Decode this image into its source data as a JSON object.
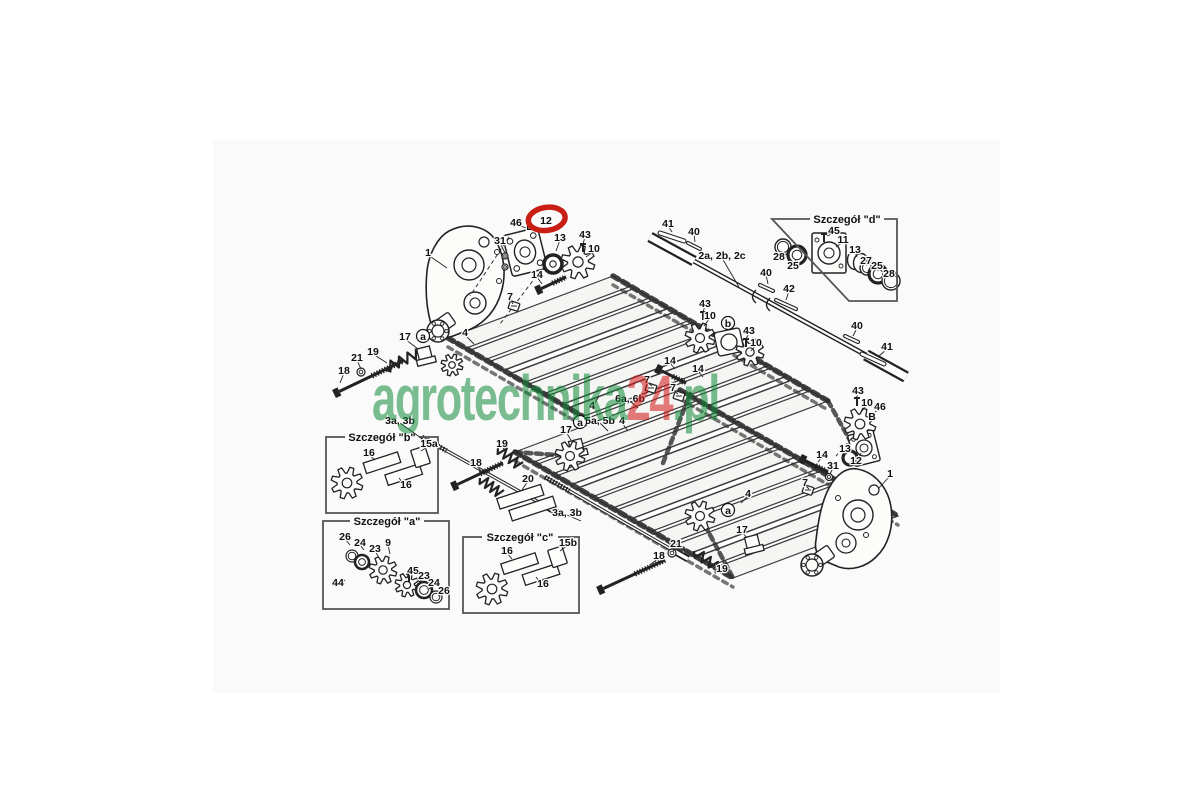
{
  "page": {
    "background": "#ffffff",
    "image_area_background": "#fafafa"
  },
  "watermark": {
    "part1": "agrotechnika",
    "part2": "24",
    "part3": ".pl",
    "color_main": "#0f8a38",
    "color_accent": "#d21414",
    "opacity": 0.55
  },
  "diagram": {
    "highlight_color": "#c81e14",
    "line_color": "#222222",
    "detail_boxes": [
      {
        "id": "d",
        "label": "Szczegół \"d\""
      },
      {
        "id": "b",
        "label": "Szczegół \"b\""
      },
      {
        "id": "a",
        "label": "Szczegół \"a\""
      },
      {
        "id": "c",
        "label": "Szczegół \"c\""
      }
    ],
    "callouts": [
      {
        "label": "1",
        "x": 428,
        "y": 253,
        "lx": 447,
        "ly": 268
      },
      {
        "label": "46",
        "x": 516,
        "y": 223,
        "lx": 527,
        "ly": 228
      },
      {
        "label": "B",
        "x": 530,
        "y": 227
      },
      {
        "label": "12",
        "x": 546,
        "y": 221,
        "highlight": true
      },
      {
        "label": "31",
        "x": 500,
        "y": 241,
        "lx": 505,
        "ly": 253
      },
      {
        "label": "13",
        "x": 560,
        "y": 238,
        "lx": 556,
        "ly": 251
      },
      {
        "label": "43",
        "x": 585,
        "y": 235,
        "lx": 583,
        "ly": 244
      },
      {
        "label": "10",
        "x": 594,
        "y": 249,
        "lx": 586,
        "ly": 257
      },
      {
        "label": "14",
        "x": 537,
        "y": 275,
        "lx": 542,
        "ly": 284
      },
      {
        "label": "7",
        "x": 510,
        "y": 297,
        "lx": 513,
        "ly": 304
      },
      {
        "label": "4",
        "x": 465,
        "y": 333,
        "lx": 474,
        "ly": 344
      },
      {
        "label": "17",
        "x": 405,
        "y": 337,
        "lx": 418,
        "ly": 349
      },
      {
        "label": "a",
        "x": 423,
        "y": 337,
        "circled": true
      },
      {
        "label": "19",
        "x": 373,
        "y": 352,
        "lx": 387,
        "ly": 363
      },
      {
        "label": "21",
        "x": 357,
        "y": 358,
        "lx": 361,
        "ly": 369
      },
      {
        "label": "18",
        "x": 344,
        "y": 371,
        "lx": 340,
        "ly": 383
      },
      {
        "label": "3a, 3b",
        "x": 400,
        "y": 421,
        "lx": 428,
        "ly": 443
      },
      {
        "label": "41",
        "x": 668,
        "y": 224,
        "lx": 672,
        "ly": 232
      },
      {
        "label": "40",
        "x": 694,
        "y": 232,
        "lx": 695,
        "ly": 242
      },
      {
        "label": "2a, 2b, 2c",
        "x": 722,
        "y": 256,
        "lx": 739,
        "ly": 287
      },
      {
        "label": "40",
        "x": 766,
        "y": 273,
        "lx": 768,
        "ly": 284
      },
      {
        "label": "42",
        "x": 789,
        "y": 289,
        "lx": 786,
        "ly": 300
      },
      {
        "label": "43",
        "x": 705,
        "y": 304,
        "lx": 703,
        "ly": 312
      },
      {
        "label": "10",
        "x": 710,
        "y": 316,
        "lx": 704,
        "ly": 326
      },
      {
        "label": "b",
        "x": 728,
        "y": 324,
        "circled": true
      },
      {
        "label": "43",
        "x": 749,
        "y": 331,
        "lx": 746,
        "ly": 339
      },
      {
        "label": "10",
        "x": 756,
        "y": 343,
        "lx": 751,
        "ly": 351
      },
      {
        "label": "40",
        "x": 857,
        "y": 326,
        "lx": 853,
        "ly": 336
      },
      {
        "label": "41",
        "x": 887,
        "y": 347,
        "lx": 879,
        "ly": 356
      },
      {
        "label": "14",
        "x": 670,
        "y": 361,
        "lx": 675,
        "ly": 369
      },
      {
        "label": "14",
        "x": 698,
        "y": 369,
        "lx": 703,
        "ly": 377
      },
      {
        "label": "7",
        "x": 647,
        "y": 380,
        "lx": 652,
        "ly": 386
      },
      {
        "label": "7",
        "x": 673,
        "y": 388,
        "lx": 678,
        "ly": 394
      },
      {
        "label": "6a, 6b",
        "x": 630,
        "y": 399,
        "lx": 638,
        "ly": 408
      },
      {
        "label": "4",
        "x": 592,
        "y": 406,
        "lx": 599,
        "ly": 396
      },
      {
        "label": "5a, 5b",
        "x": 600,
        "y": 421,
        "lx": 608,
        "ly": 431
      },
      {
        "label": "4",
        "x": 622,
        "y": 421,
        "lx": 628,
        "ly": 431
      },
      {
        "label": "17",
        "x": 566,
        "y": 430,
        "lx": 571,
        "ly": 440
      },
      {
        "label": "a",
        "x": 580,
        "y": 423,
        "circled": true
      },
      {
        "label": "19",
        "x": 502,
        "y": 444,
        "lx": 505,
        "ly": 451
      },
      {
        "label": "18",
        "x": 476,
        "y": 463,
        "lx": 481,
        "ly": 471
      },
      {
        "label": "20",
        "x": 528,
        "y": 479,
        "lx": 522,
        "ly": 490
      },
      {
        "label": "3a, 3b",
        "x": 567,
        "y": 513,
        "lx": 581,
        "ly": 521
      },
      {
        "label": "21",
        "x": 676,
        "y": 544,
        "lx": 673,
        "ly": 551
      },
      {
        "label": "18",
        "x": 659,
        "y": 556,
        "lx": 651,
        "ly": 564
      },
      {
        "label": "4",
        "x": 748,
        "y": 494,
        "lx": 741,
        "ly": 503
      },
      {
        "label": "a",
        "x": 728,
        "y": 511,
        "circled": true
      },
      {
        "label": "17",
        "x": 742,
        "y": 530,
        "lx": 747,
        "ly": 538
      },
      {
        "label": "19",
        "x": 722,
        "y": 569,
        "lx": 715,
        "ly": 566
      },
      {
        "label": "43",
        "x": 858,
        "y": 391,
        "lx": 856,
        "ly": 399
      },
      {
        "label": "10",
        "x": 867,
        "y": 403,
        "lx": 862,
        "ly": 411
      },
      {
        "label": "46",
        "x": 880,
        "y": 407,
        "lx": 875,
        "ly": 412
      },
      {
        "label": "B",
        "x": 872,
        "y": 417
      },
      {
        "label": "13",
        "x": 845,
        "y": 449,
        "lx": 850,
        "ly": 442
      },
      {
        "label": "12",
        "x": 856,
        "y": 461,
        "lx": 861,
        "ly": 453
      },
      {
        "label": "14",
        "x": 822,
        "y": 455,
        "lx": 818,
        "ly": 462
      },
      {
        "label": "31",
        "x": 833,
        "y": 466,
        "lx": 830,
        "ly": 474
      },
      {
        "label": "7",
        "x": 805,
        "y": 483,
        "lx": 809,
        "ly": 489
      },
      {
        "label": "1",
        "x": 890,
        "y": 474,
        "lx": 878,
        "ly": 489
      },
      {
        "label": "45",
        "x": 834,
        "y": 231,
        "lx": 827,
        "ly": 236
      },
      {
        "label": "11",
        "x": 843,
        "y": 240,
        "lx": 836,
        "ly": 247
      },
      {
        "label": "13",
        "x": 855,
        "y": 250,
        "lx": 857,
        "ly": 257
      },
      {
        "label": "27",
        "x": 866,
        "y": 261,
        "lx": 867,
        "ly": 266
      },
      {
        "label": "25",
        "x": 877,
        "y": 266,
        "lx": 878,
        "ly": 271
      },
      {
        "label": "28",
        "x": 889,
        "y": 274,
        "lx": 890,
        "ly": 278
      },
      {
        "label": "28",
        "x": 779,
        "y": 257,
        "lx": 782,
        "ly": 251
      },
      {
        "label": "25",
        "x": 793,
        "y": 266,
        "lx": 796,
        "ly": 259
      },
      {
        "label": "16",
        "x": 369,
        "y": 453,
        "lx": 375,
        "ly": 460
      },
      {
        "label": "15a",
        "x": 429,
        "y": 444,
        "lx": 421,
        "ly": 451
      },
      {
        "label": "16",
        "x": 406,
        "y": 485,
        "lx": 399,
        "ly": 478
      },
      {
        "label": "26",
        "x": 345,
        "y": 537,
        "lx": 350,
        "ly": 545
      },
      {
        "label": "24",
        "x": 360,
        "y": 543,
        "lx": 364,
        "ly": 550
      },
      {
        "label": "23",
        "x": 375,
        "y": 549,
        "lx": 378,
        "ly": 556
      },
      {
        "label": "9",
        "x": 388,
        "y": 543,
        "lx": 390,
        "ly": 554
      },
      {
        "label": "44",
        "x": 338,
        "y": 583,
        "lx": 345,
        "ly": 580
      },
      {
        "label": "45",
        "x": 413,
        "y": 571,
        "lx": 408,
        "ly": 576
      },
      {
        "label": "23",
        "x": 424,
        "y": 576,
        "lx": 419,
        "ly": 582
      },
      {
        "label": "24",
        "x": 434,
        "y": 583,
        "lx": 429,
        "ly": 589
      },
      {
        "label": "26",
        "x": 444,
        "y": 591,
        "lx": 438,
        "ly": 596
      },
      {
        "label": "16",
        "x": 507,
        "y": 551,
        "lx": 512,
        "ly": 559
      },
      {
        "label": "15b",
        "x": 568,
        "y": 543,
        "lx": 560,
        "ly": 551
      },
      {
        "label": "16",
        "x": 543,
        "y": 584,
        "lx": 536,
        "ly": 577
      }
    ]
  }
}
